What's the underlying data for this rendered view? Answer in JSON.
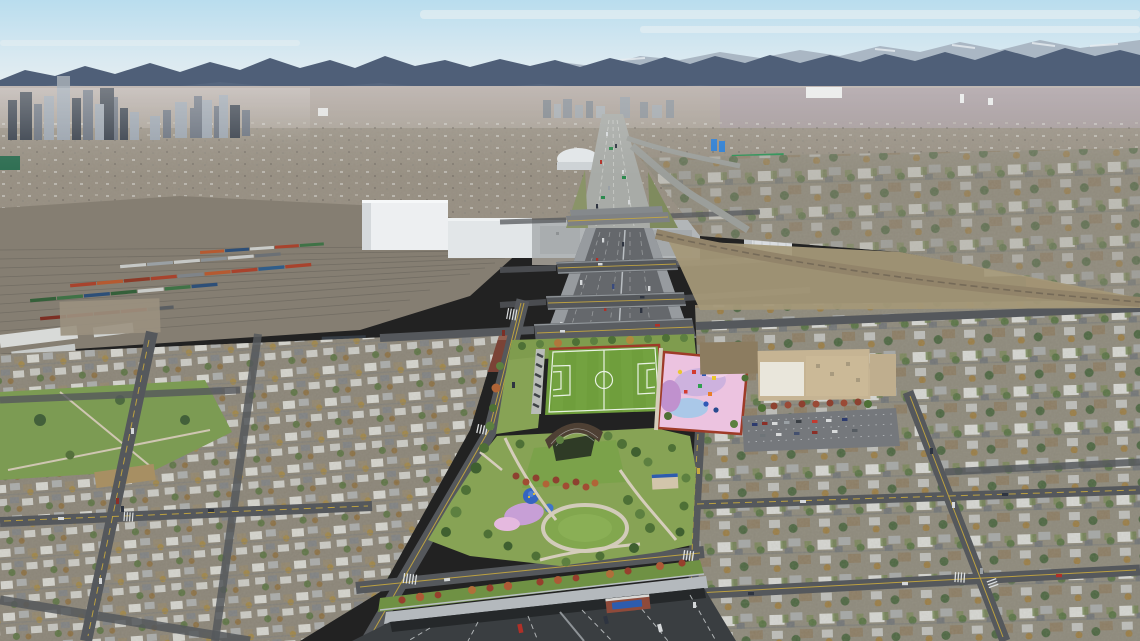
{
  "meta": {
    "kind": "aerial-photo-rendering",
    "caption": "Aerial rendering of a sunken interstate covered by a neighborhood park cap (soccer field, playgrounds, amphitheater), flanked by residential blocks, rail yards, industry, a downtown skyline and a mountain range on the horizon.",
    "width": 1140,
    "height": 641
  },
  "scene": {
    "landmarks": [
      "mountain-range-horizon",
      "snowy-peaks-right",
      "downtown-skyline-left",
      "rail-yard-with-freight-trains",
      "white-warehouses",
      "grain-elevator",
      "white-dome-arena",
      "green-big-box-warehouse",
      "sunken-highway-trench",
      "cross-street-bridges",
      "diagonal-rail-line",
      "park-cap-over-highway",
      "soccer-field",
      "pink-playground",
      "amphitheater-canopy",
      "splash-pad",
      "circular-lawn",
      "blue-shade-canopy",
      "school-building",
      "school-parking-lot",
      "highway-tunnel-portal",
      "brick-monument-sign",
      "residential-neighborhoods",
      "neighborhood-park-southwest",
      "street-grid-with-crosswalks"
    ]
  },
  "palette": {
    "sky_top": "#b9ddee",
    "sky_mid": "#d9e9f1",
    "sky_horizon": "#edf1f1",
    "cloud": "#f2f4f4",
    "mountain_far": "#aab7c4",
    "mountain_near": "#4f5f78",
    "foothill": "#5d6c83",
    "snow": "#e8edf1",
    "valley_top": "#b3a9a4",
    "valley_bottom": "#a19a8c",
    "valley_mauve": "#a195a3",
    "city_band": "#968e81",
    "speck_light": "#d9d9d4",
    "speck_dark": "#6f6a62",
    "skyline_dark": "#39414c",
    "skyline_mid": "#6a727e",
    "skyline_light": "#99a2ac",
    "railyard": "#857e72",
    "rail_line": "#6e6960",
    "train_red": "#a8432d",
    "train_orange": "#b55a31",
    "train_green": "#3f7246",
    "train_blue": "#2d4f78",
    "train_white": "#c6c8c6",
    "train_dark": "#7c2f24",
    "warehouse_white": "#edeff1",
    "warehouse_shade": "#d5d9dc",
    "industry_gray": "#b2b6b8",
    "dome_white": "#e2e6e8",
    "bigbox_green": "#2f9358",
    "silo_blue": "#2f7fd2",
    "brick_dark": "#7d3a2c",
    "highway_concrete": "#a8aba7",
    "trench_asphalt": "#65686c",
    "trench_wall": "#9ca1a5",
    "bridge_asphalt": "#54575b",
    "road_gray": "#55585c",
    "road_light": "#7e8184",
    "lane_yellow": "#c8a93f",
    "lane_white": "#d8dad6",
    "sidewalk": "#c2bcae",
    "cap_green": "#87a355",
    "lawn_green": "#7ba24a",
    "field_green": "#6f9e3c",
    "field_stripe": "#7aa945",
    "field_line": "#e9f2e4",
    "circle_lawn": "#82a74e",
    "north_lawn": "#7f9c4e",
    "strip_green": "#6f9144",
    "border_red": "#9e3b28",
    "playground_pink": "#ecc3e0",
    "playground_lavender": "#cdb2de",
    "splash_blue": "#aac8e8",
    "play_purple": "#c79fd6",
    "play_magenta": "#e5b9df",
    "canopy_brown": "#4e4034",
    "canopy_blue": "#3565bf",
    "tree_green": "#4e7036",
    "tree_light": "#5d8040",
    "tree_dark": "#3f6030",
    "tree_red": "#8d4130",
    "tree_rust": "#a14c33",
    "tree_orange": "#b06437",
    "tree_gold": "#b0893e",
    "school_tan": "#c6b493",
    "school_roof": "#e9e6db",
    "school_brown": "#8c7c60",
    "parking_gray": "#75787c",
    "portal_wall": "#b4b9bd",
    "portal_dark": "#3a3e41",
    "portal_deep": "#25282a",
    "monument_brick": "#8f4a3a",
    "sign_blue": "#2d5cae",
    "hood_left": "#8a8477",
    "hood_right": "#8d897b",
    "grass_park": "#7c9b53",
    "dirt": "#9b9180",
    "house_white": "#dfe1de",
    "house_gray": "#a8abac",
    "house_brown": "#8b7a60",
    "house_light": "#c3c5c2",
    "car_red": "#b03028",
    "car_dark": "#2e3440",
    "car_white": "#d5d8da"
  }
}
